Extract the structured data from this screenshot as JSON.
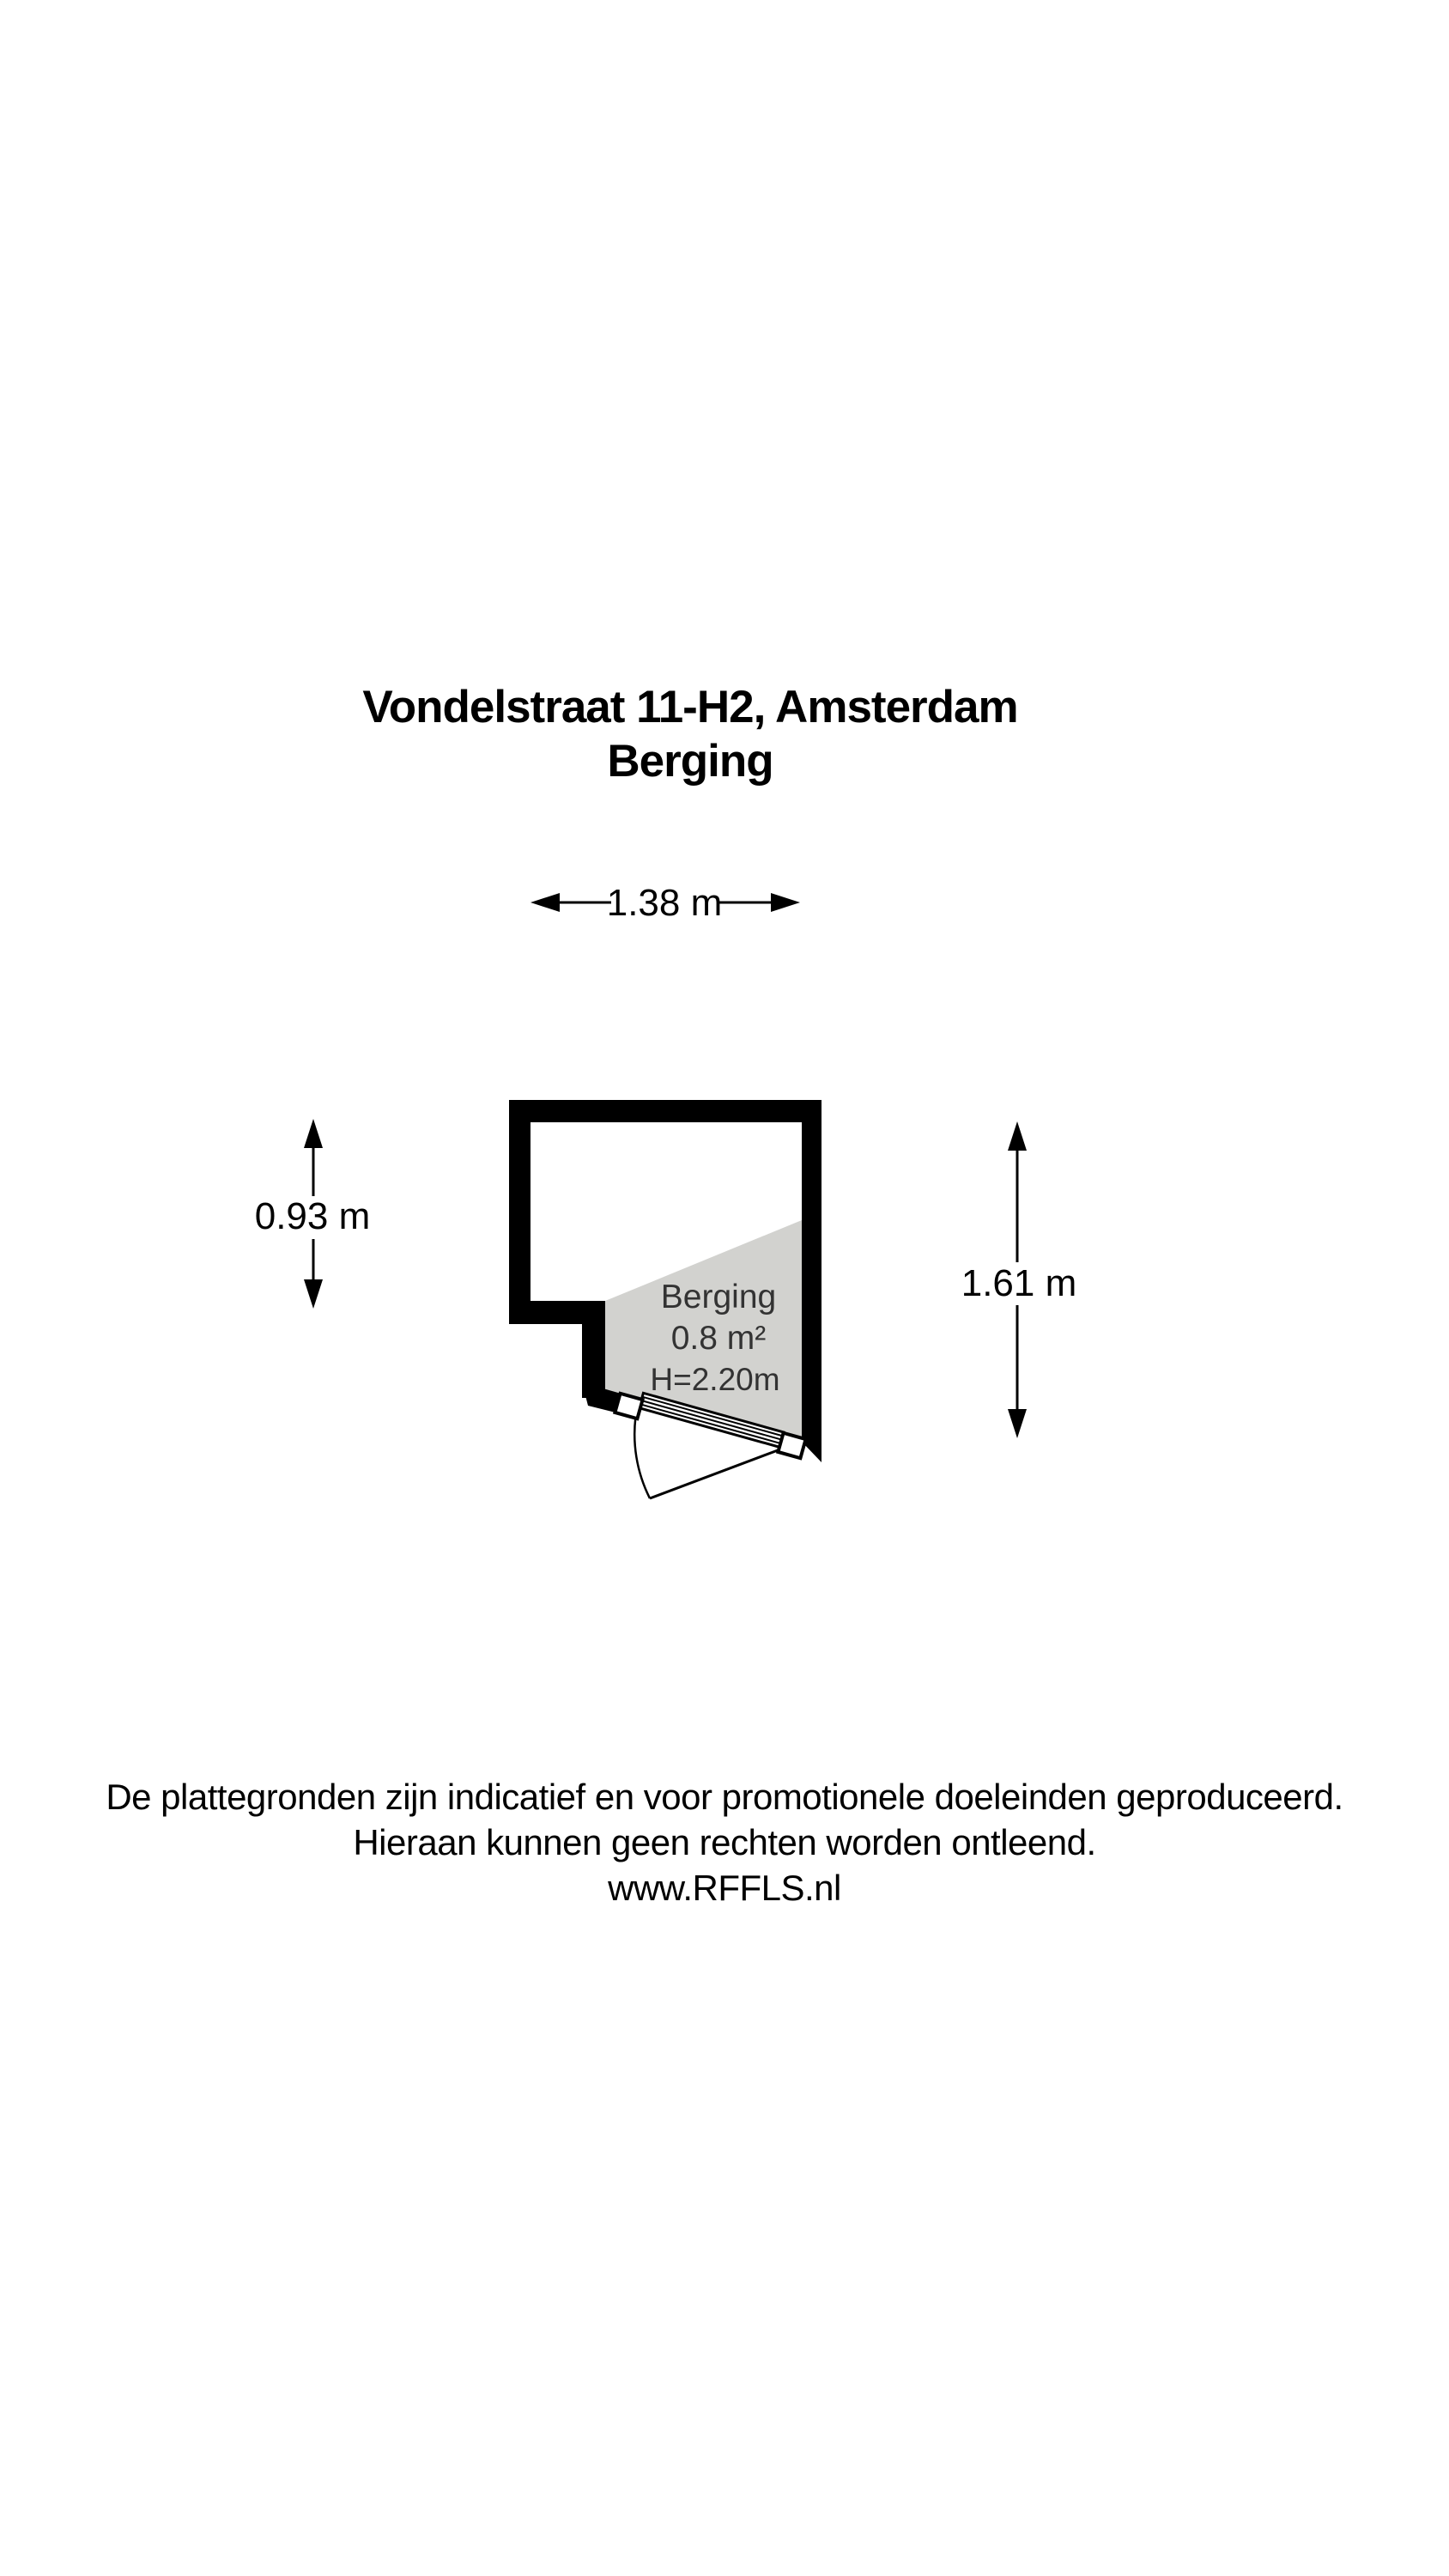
{
  "title": {
    "line1": "Vondelstraat 11-H2, Amsterdam",
    "line2": "Berging"
  },
  "dimensions": {
    "top": "1.38 m",
    "left": "0.93 m",
    "right": "1.61 m",
    "bottom": "1.00 m"
  },
  "room": {
    "name": "Berging",
    "area": "0.8 m²",
    "height": "H=2.20m"
  },
  "footer": {
    "line1": "De plattegronden zijn indicatief en voor promotionele doeleinden geproduceerd.",
    "line2": "Hieraan kunnen geen rechten worden ontleend.",
    "line3": "www.RFFLS.nl"
  },
  "colors": {
    "wall": "#000000",
    "room_fill": "#d2d2cf",
    "room_label": "#333333",
    "text": "#000000",
    "background": "#ffffff"
  }
}
